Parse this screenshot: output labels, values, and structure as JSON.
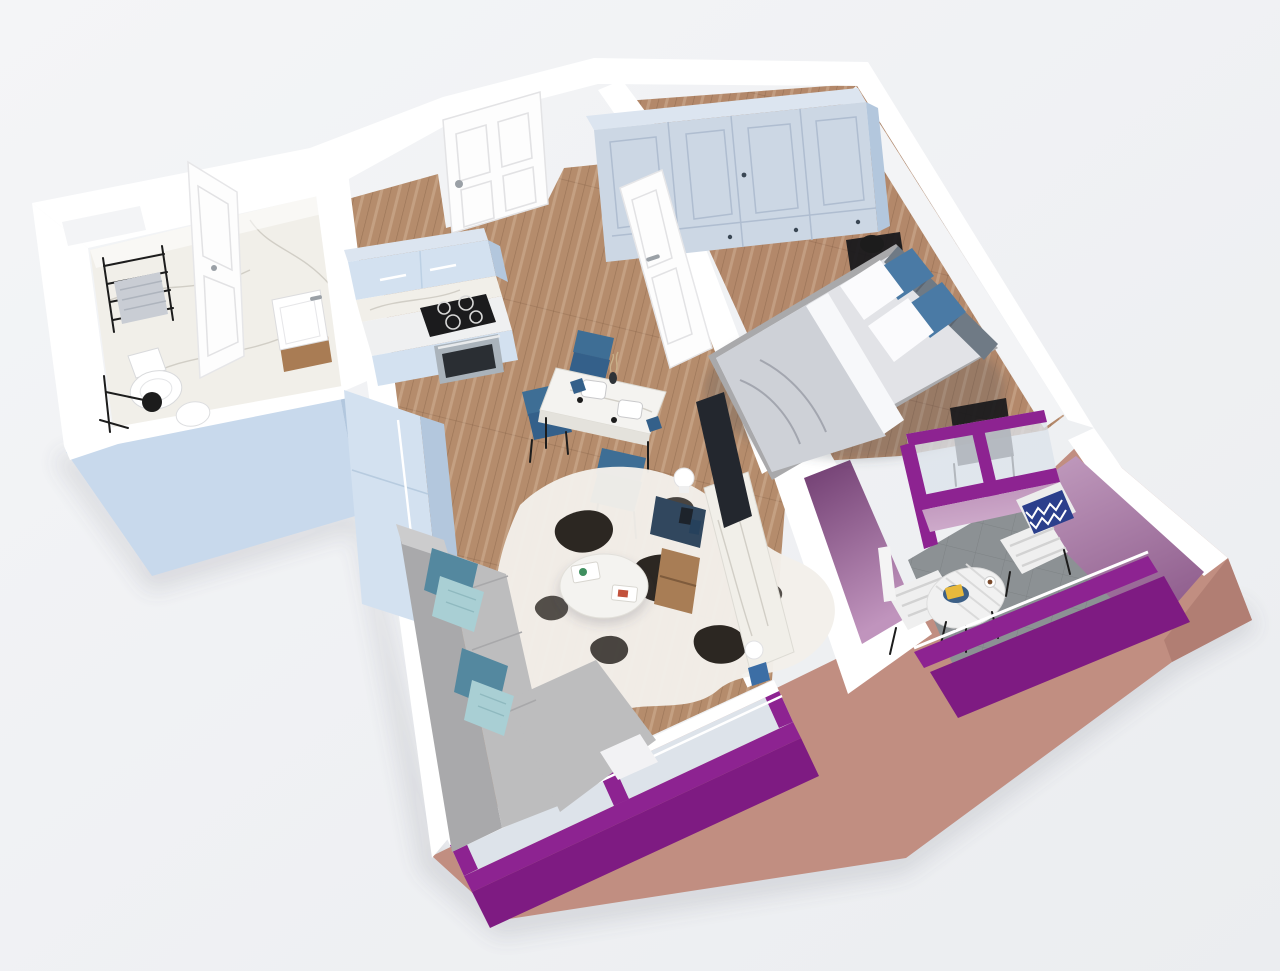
{
  "meta": {
    "title": "3D isometric cutaway render of a one-bedroom apartment floor plan",
    "view": "axonometric top-down cutaway",
    "visible_text": ""
  },
  "colors": {
    "bg": "#f2f3f5",
    "bg2": "#e8eaed",
    "wall_white": "#ffffff",
    "wall_light": "#f3f4f6",
    "wall_shade": "#e4e7eb",
    "ext_blue": "#c8d9ec",
    "ext_blue_dark": "#b2c7de",
    "ext_salmon": "#c18e81",
    "ext_salmon_dark": "#ad7b6f",
    "magenta": "#8d2391",
    "magenta_dark": "#6d1a72",
    "magenta_deep": "#7e1b82",
    "lilac": "#c3a0c0",
    "mauve": "#9a6898",
    "purple_dark": "#6f3c70",
    "purple_light": "#c094bd",
    "wood": "#b58c6c",
    "wood_dark": "#9c males",
    "wood_light": "#c9a584",
    "wood_bedroom": "#b3886a",
    "marble": "#f1efe9",
    "marble_vein": "#c9c6bd",
    "balcony_floor": "#8c9194",
    "cabinet": "#d3e1f0",
    "cabinet_side": "#b3c7dd",
    "counter": "#eff0f1",
    "stove": "#1b1b1d",
    "oven": "#aab3bb",
    "sofa": "#bdbdbe",
    "sofa_dark": "#a9a9ab",
    "teal": "#54889f",
    "teal_light": "#a9cfd4",
    "rug": "#f3f0ea",
    "rug_spot": "#2c2722",
    "table_white": "#f4f3f0",
    "chair_blue": "#3e6e95",
    "chair_blue_dark": "#34608a",
    "console_navy": "#31475e",
    "console_wood": "#a87d55",
    "tv": "#23272e",
    "mattress": "#e2e3e7",
    "duvet": "#ced1d7",
    "sheet": "#f7f8fa",
    "headboard": "#6f7a85",
    "pillow_blue": "#4a7aa5",
    "pillow_white": "#fbfbfd",
    "wardrobe": "#ccd7e4",
    "wardrobe_top": "#dce5f0",
    "wardrobe_line": "#afbdd0",
    "black": "#1c1c1c",
    "chrome": "#9aa0a6",
    "glass": "#dde3ea",
    "door": "#fdfdfd",
    "door_line": "#e2e2e4",
    "chevron": "#2b3f8c",
    "yellow": "#e8b93c",
    "shadow": "rgba(90,95,110,0.18)"
  },
  "scene": {
    "style": "white cut walls, magenta window frames, salmon exterior base, light-blue service-block exterior",
    "rooms": [
      {
        "id": "bathroom",
        "label": "Bathroom",
        "floor": "white marble",
        "furniture": [
          "black towel ladder with grey towel",
          "white toilet",
          "black shower set",
          "white washbasin on wood counter",
          "open white door"
        ]
      },
      {
        "id": "hallway",
        "label": "Hallway / entry",
        "floor": "wood planks",
        "furniture": [
          "white panel entrance door",
          "open bedroom door"
        ]
      },
      {
        "id": "kitchen",
        "label": "Kitchen",
        "floor": "wood planks",
        "furniture": [
          "light-blue upper cabinets",
          "marble backsplash",
          "black cooktop with 4 burners",
          "steel oven",
          "light-blue base cabinets",
          "tall light-blue fridge column"
        ]
      },
      {
        "id": "dining",
        "label": "Dining corner",
        "floor": "wood planks",
        "furniture": [
          "square marble table",
          "3 blue chairs",
          "2 white place settings",
          "small vase"
        ]
      },
      {
        "id": "living",
        "label": "Living room",
        "floor": "wood planks",
        "furniture": [
          "grey corner sofa",
          "2 teal pillows",
          "2 patterned light-blue pillows",
          "cowhide rug",
          "round white coffee table with magazines",
          "marble TV panel",
          "wall TV",
          "navy media cabinet",
          "wood shelf unit",
          "white sphere table lamp",
          "magenta framed window"
        ]
      },
      {
        "id": "bedroom",
        "label": "Bedroom",
        "floor": "wood planks",
        "furniture": [
          "full-wall light-blue wardrobe",
          "double bed with grey duvet",
          "2 blue pillows",
          "2 white pillows",
          "grey headboard cushions",
          "2 black metal nightstands",
          "black lamp",
          "magenta glazed wall to balcony"
        ]
      },
      {
        "id": "balcony",
        "label": "Balcony",
        "floor": "grey screed",
        "furniture": [
          "round white slatted bistro table",
          "2 white slatted chairs",
          "navy chevron pillow",
          "yellow book",
          "coffee cup",
          "magenta railing"
        ]
      }
    ]
  }
}
